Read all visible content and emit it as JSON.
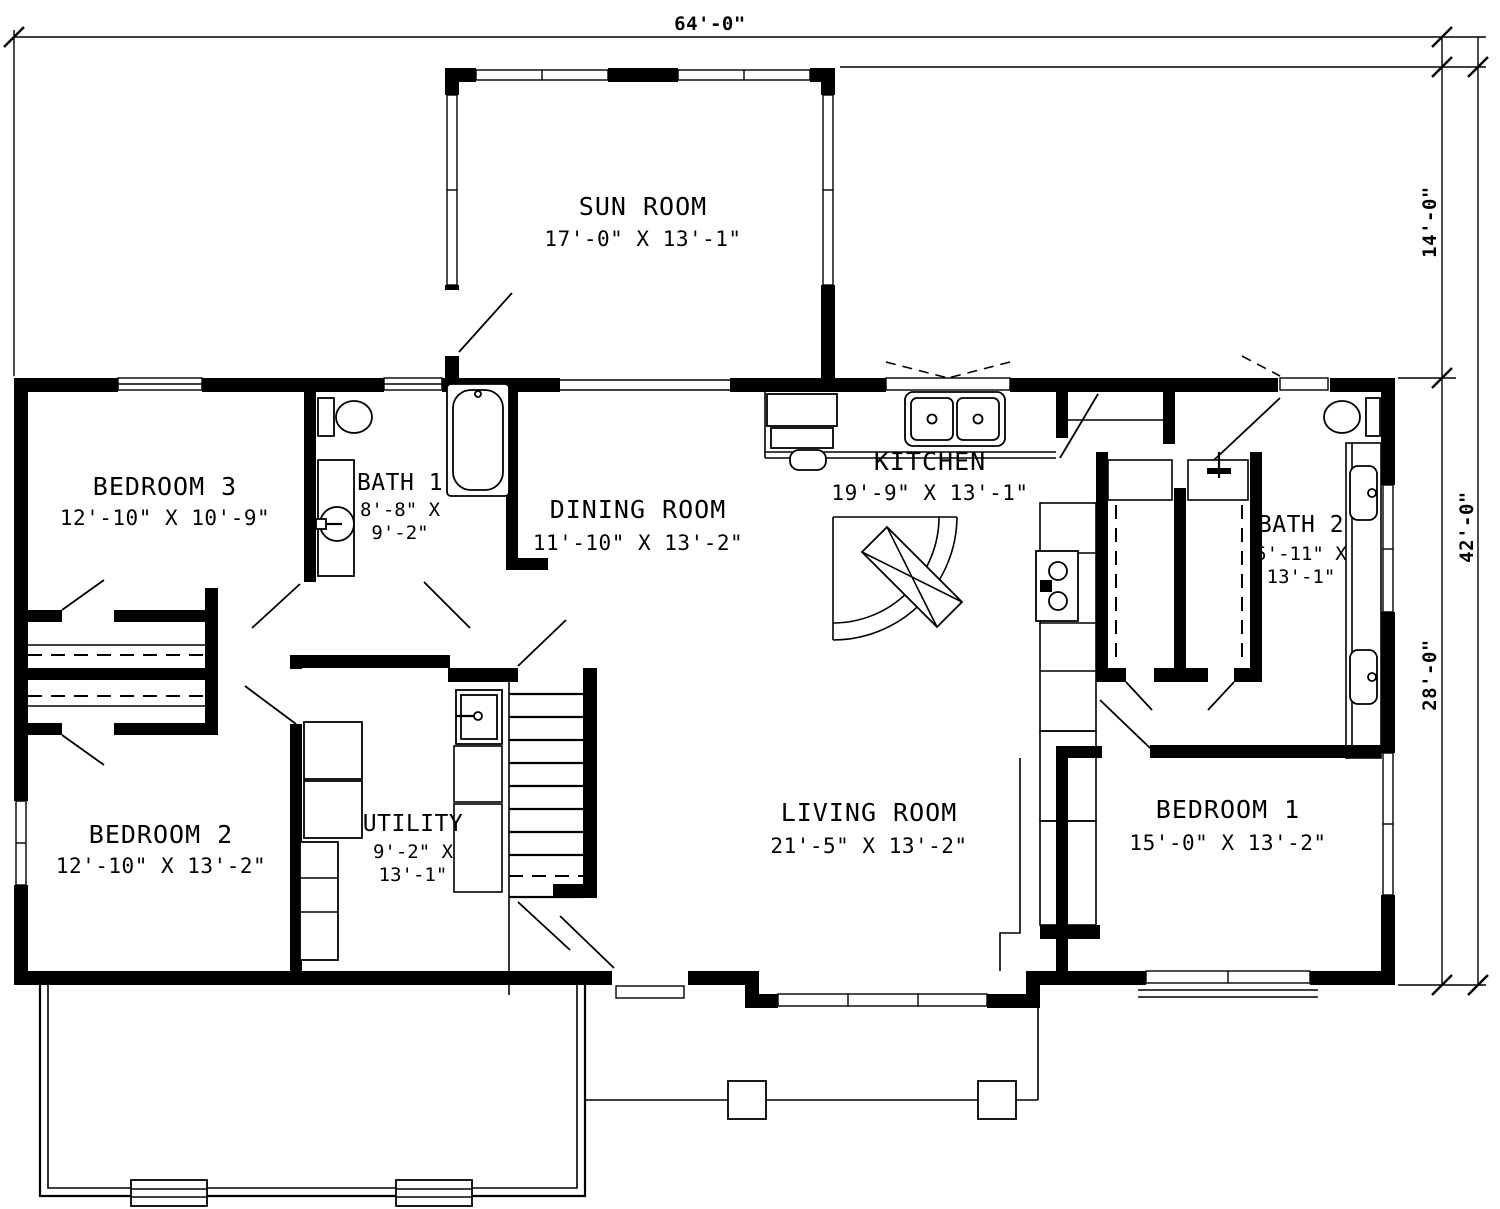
{
  "sheet": {
    "background": "#ffffff",
    "ink": "#000000"
  },
  "dimensions": {
    "overall_width": "64'-0\"",
    "sunroom_depth": "14'-0\"",
    "overall_depth": "42'-0\"",
    "main_depth": "28'-0\""
  },
  "rooms": {
    "sun_room": {
      "name": "SUN ROOM",
      "dims": "17'-0\" X 13'-1\""
    },
    "bedroom_3": {
      "name": "BEDROOM 3",
      "dims": "12'-10\" X 10'-9\""
    },
    "bath_1": {
      "name": "BATH 1",
      "dims_line1": "8'-8\" X",
      "dims_line2": "9'-2\""
    },
    "dining_room": {
      "name": "DINING ROOM",
      "dims": "11'-10\" X 13'-2\""
    },
    "kitchen": {
      "name": "KITCHEN",
      "dims": "19'-9\" X 13'-1\""
    },
    "bath_2": {
      "name": "BATH 2",
      "dims_line1": "5'-11\" X",
      "dims_line2": "13'-1\""
    },
    "bedroom_2": {
      "name": "BEDROOM 2",
      "dims": "12'-10\" X 13'-2\""
    },
    "utility": {
      "name": "UTILITY",
      "dims_line1": "9'-2\" X",
      "dims_line2": "13'-1\""
    },
    "living_room": {
      "name": "LIVING ROOM",
      "dims": "21'-5\" X 13'-2\""
    },
    "bedroom_1": {
      "name": "BEDROOM 1",
      "dims": "15'-0\" X 13'-2\""
    }
  }
}
